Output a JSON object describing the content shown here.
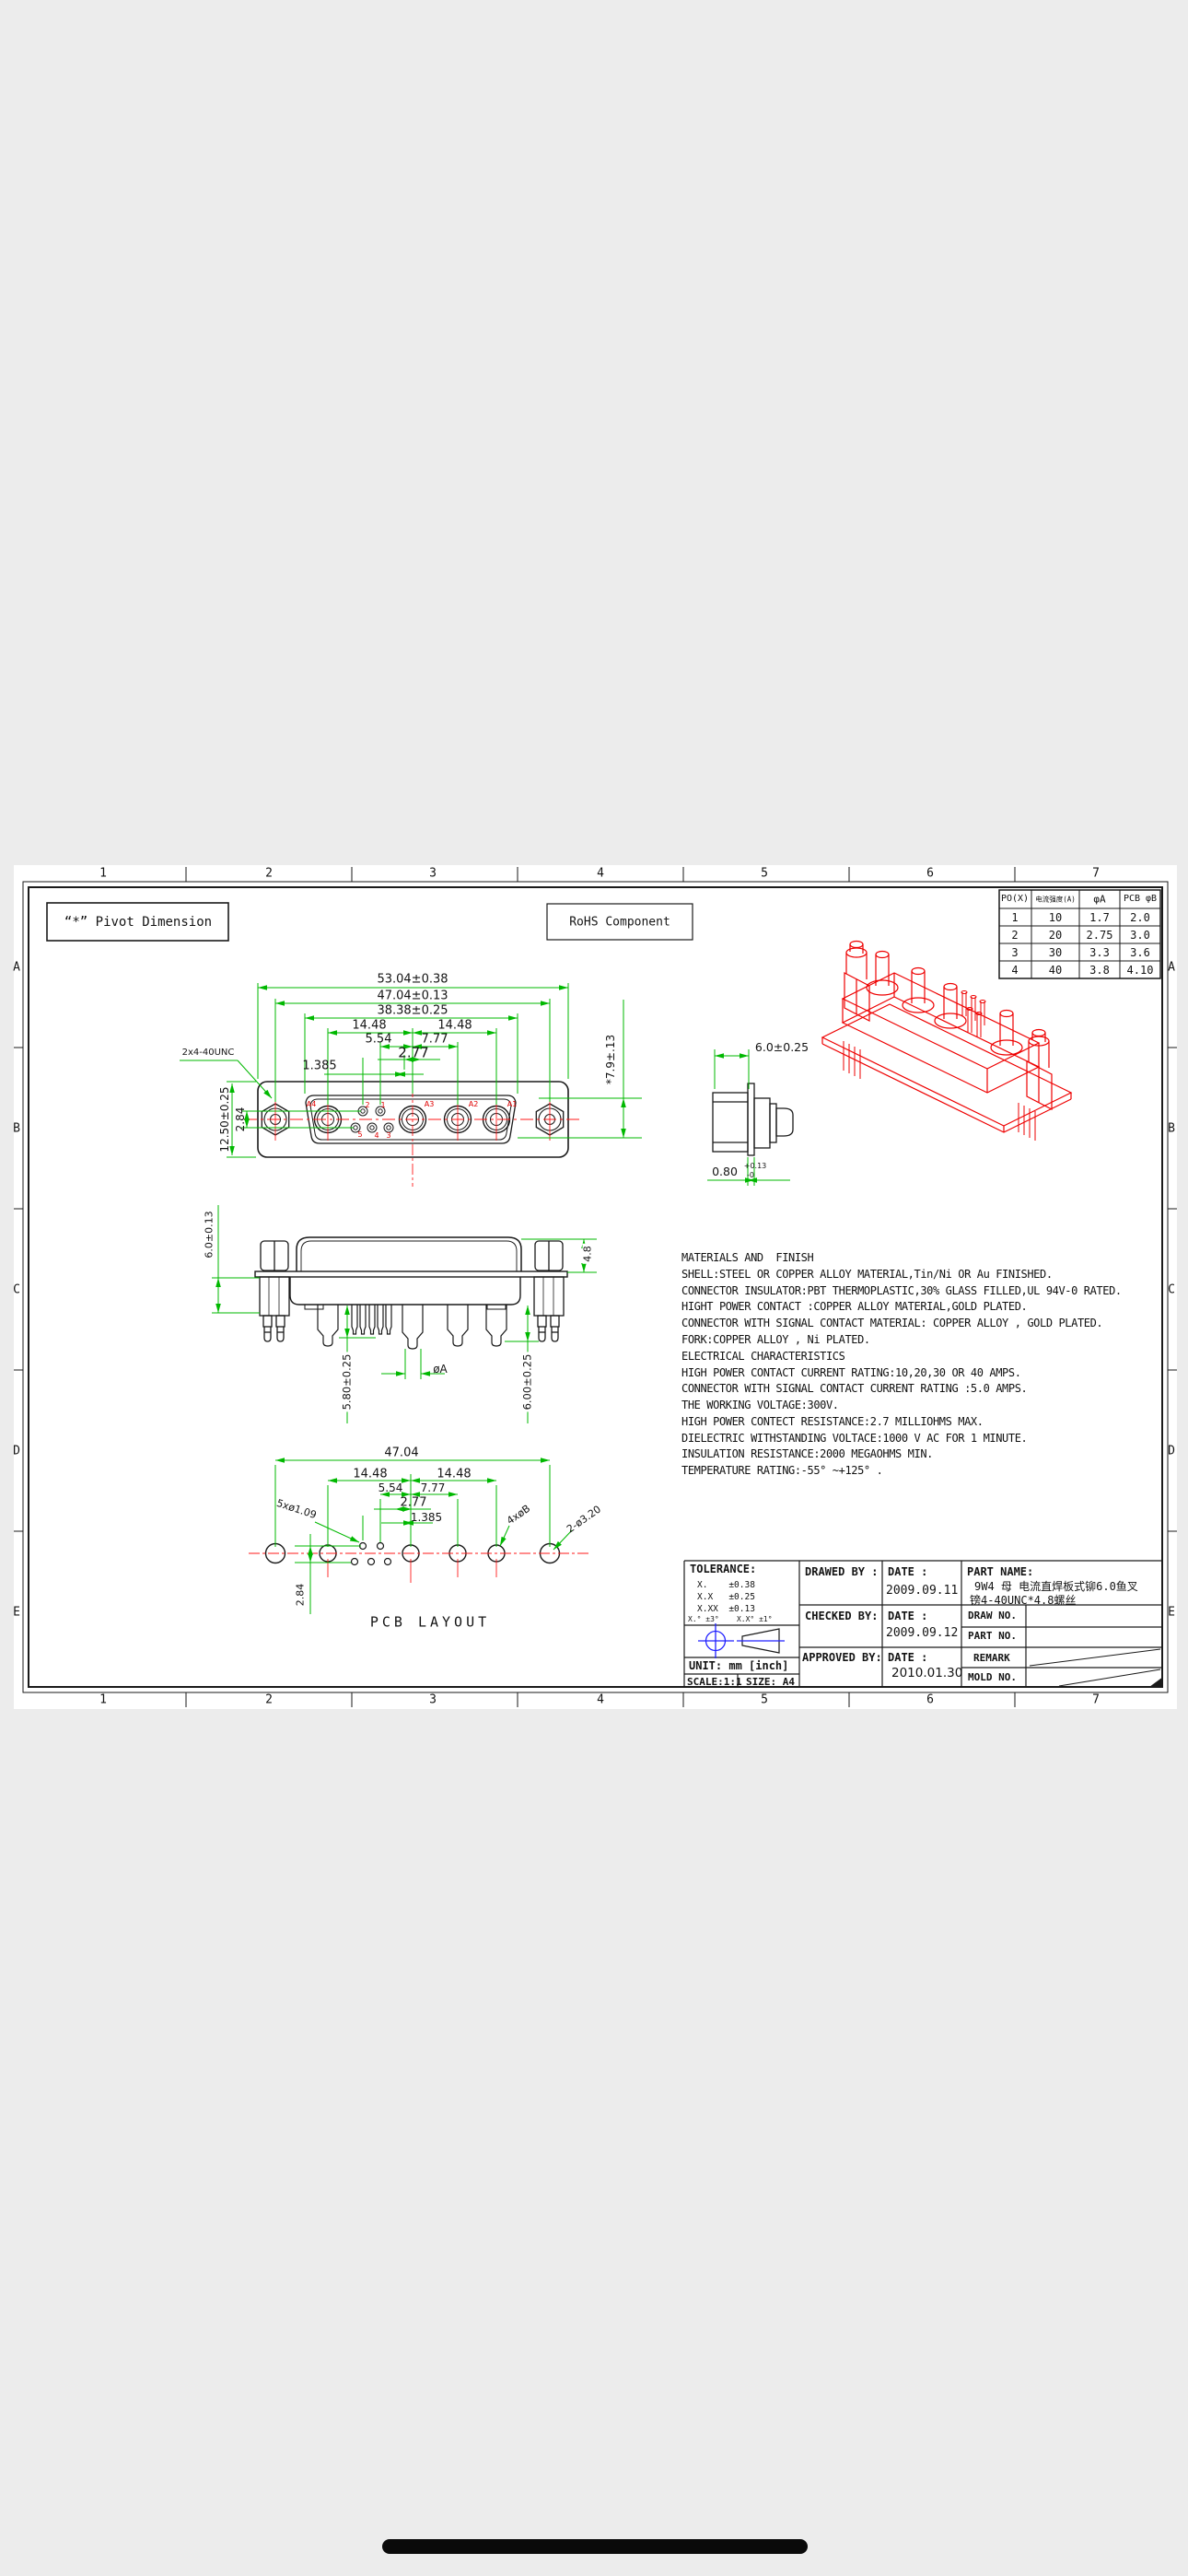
{
  "frame": {
    "columns": [
      "1",
      "2",
      "3",
      "4",
      "5",
      "6",
      "7"
    ],
    "rows": [
      "A",
      "B",
      "C",
      "D",
      "E"
    ]
  },
  "callouts": {
    "pivot": "“*” Pivot Dimension",
    "rohs": "RoHS  Component"
  },
  "current_table": {
    "headers": [
      "PO(X)",
      "电流强度(A)",
      "φA",
      "PCB φB"
    ],
    "rows": [
      [
        "1",
        "10",
        "1.7",
        "2.0"
      ],
      [
        "2",
        "20",
        "2.75",
        "3.0"
      ],
      [
        "3",
        "30",
        "3.3",
        "3.6"
      ],
      [
        "4",
        "40",
        "3.8",
        "4.10"
      ]
    ]
  },
  "front_view": {
    "dim_53": "53.04±0.38",
    "dim_47": "47.04±0.13",
    "dim_38": "38.38±0.25",
    "dim_14a": "14.48",
    "dim_14b": "14.48",
    "dim_554": "5.54",
    "dim_777": "7.77",
    "dim_277": "2.77",
    "dim_1385": "1.385",
    "dim_1250": "12.50±0.25",
    "dim_284": "2.84",
    "thread": "2x4-40UNC",
    "dim_79": "*7.9±.13",
    "pins": {
      "a4": "A4",
      "a3": "A3",
      "a2": "A2",
      "a1": "A1",
      "s1": "1",
      "s2": "2",
      "s3": "3",
      "s4": "4",
      "s5": "5"
    }
  },
  "side_view": {
    "dim_60": "6.0±0.25",
    "dim_080": "0.80",
    "dim_080_up": "+0.13",
    "dim_080_dn": "-0"
  },
  "rear_view": {
    "dim_48": "4.8",
    "dim_6013": "6.0±0.13",
    "dim_580": "5.80±0.25",
    "dim_phiA": "øA",
    "dim_600": "6.00±0.25"
  },
  "pcb": {
    "dim_4704": "47.04",
    "dim_14a": "14.48",
    "dim_14b": "14.48",
    "dim_554": "5.54",
    "dim_777": "7.77",
    "dim_277": "2.77",
    "dim_1385": "1.385",
    "dim_284": "2.84",
    "hole_small": "5xø1.09",
    "hole_power": "4xøB",
    "hole_mount": "2-ø3.20",
    "title": "PCB  LAYOUT"
  },
  "materials": {
    "lines": [
      "MATERIALS AND  FINISH",
      "SHELL:STEEL OR COPPER ALLOY MATERIAL,Tin/Ni OR Au FINISHED.",
      "CONNECTOR INSULATOR:PBT THERMOPLASTIC,30% GLASS FILLED,UL 94V-0 RATED.",
      "HIGHT POWER CONTACT :COPPER ALLOY MATERIAL,GOLD PLATED.",
      "CONNECTOR WITH SIGNAL CONTACT MATERIAL: COPPER ALLOY , GOLD PLATED.",
      "FORK:COPPER ALLOY , Ni PLATED.",
      "ELECTRICAL CHARACTERISTICS",
      "HIGH POWER CONTACT CURRENT RATING:10,20,30 OR 40 AMPS.",
      "CONNECTOR WITH SIGNAL CONTACT CURRENT RATING :5.0 AMPS.",
      "THE WORKING VOLTAGE:300V.",
      "HIGH POWER CONTECT RESISTANCE:2.7 MILLIOHMS MAX.",
      "DIELECTRIC WITHSTANDING VOLTACE:1000 V AC FOR 1 MINUTE.",
      "INSULATION RESISTANCE:2000 MEGAOHMS MIN.",
      "TEMPERATURE RATING:-55° ~+125° ."
    ]
  },
  "title_block": {
    "tolerance_label": "TOLERANCE:",
    "tol_rows": [
      "X.    ±0.38",
      "X.X   ±0.25",
      "X.XX  ±0.13"
    ],
    "tol_angle": "X.° ±3°    X.X° ±1°",
    "unit": "UNIT: mm [inch]",
    "scale": "SCALE:1:1",
    "size": "SIZE: A4",
    "drawed_by": "DRAWED BY :",
    "checked_by": "CHECKED BY:",
    "approved_by": "APPROVED BY:",
    "date_label": "DATE :",
    "date_drawed": "2009.09.11",
    "date_checked": "2009.09.12",
    "date_approved": "2010.01.30",
    "part_name_label": "PART NAME:",
    "part_name_1": "9W4 母 电流直焊板式铆6.0鱼叉",
    "part_name_2": "镑4-40UNC*4.8螺丝",
    "draw_no": "DRAW NO.",
    "part_no": "PART NO.",
    "remark": "REMARK",
    "mold_no": "MOLD NO."
  }
}
